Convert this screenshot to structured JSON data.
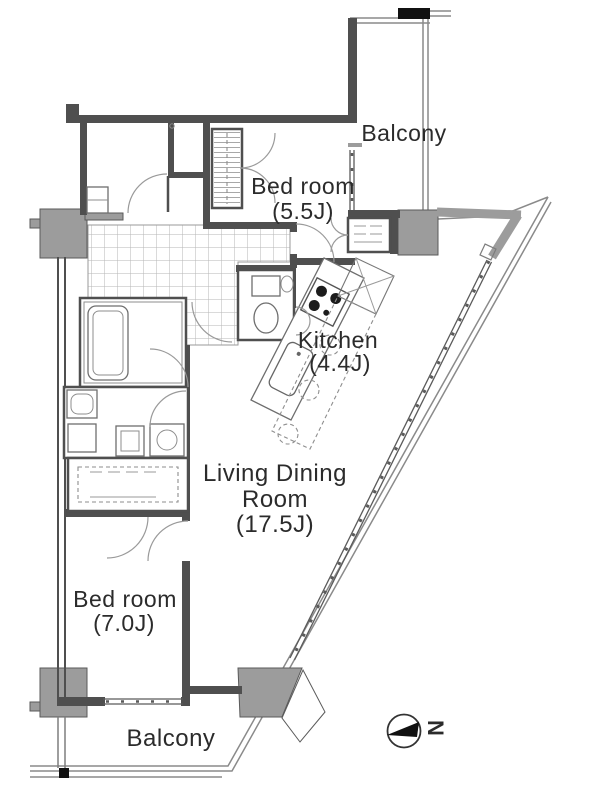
{
  "rooms": {
    "bedroom1": {
      "name": "Bed room",
      "size": "(5.5J)"
    },
    "kitchen": {
      "name": "Kitchen",
      "size": "(4.4J)"
    },
    "living": {
      "line1": "Living Dining",
      "line2": "Room",
      "size": "(17.5J)"
    },
    "bedroom2": {
      "name": "Bed room",
      "size": "(7.0J)"
    },
    "balcony_top": {
      "name": "Balcony"
    },
    "balcony_bottom": {
      "name": "Balcony"
    }
  },
  "compass": {
    "letter": "N"
  },
  "colors": {
    "wall": "#4f4f4f",
    "pillar": "#9c9c9c",
    "line": "#8a8a8a",
    "text": "#2b2b2b",
    "background": "#ffffff"
  }
}
